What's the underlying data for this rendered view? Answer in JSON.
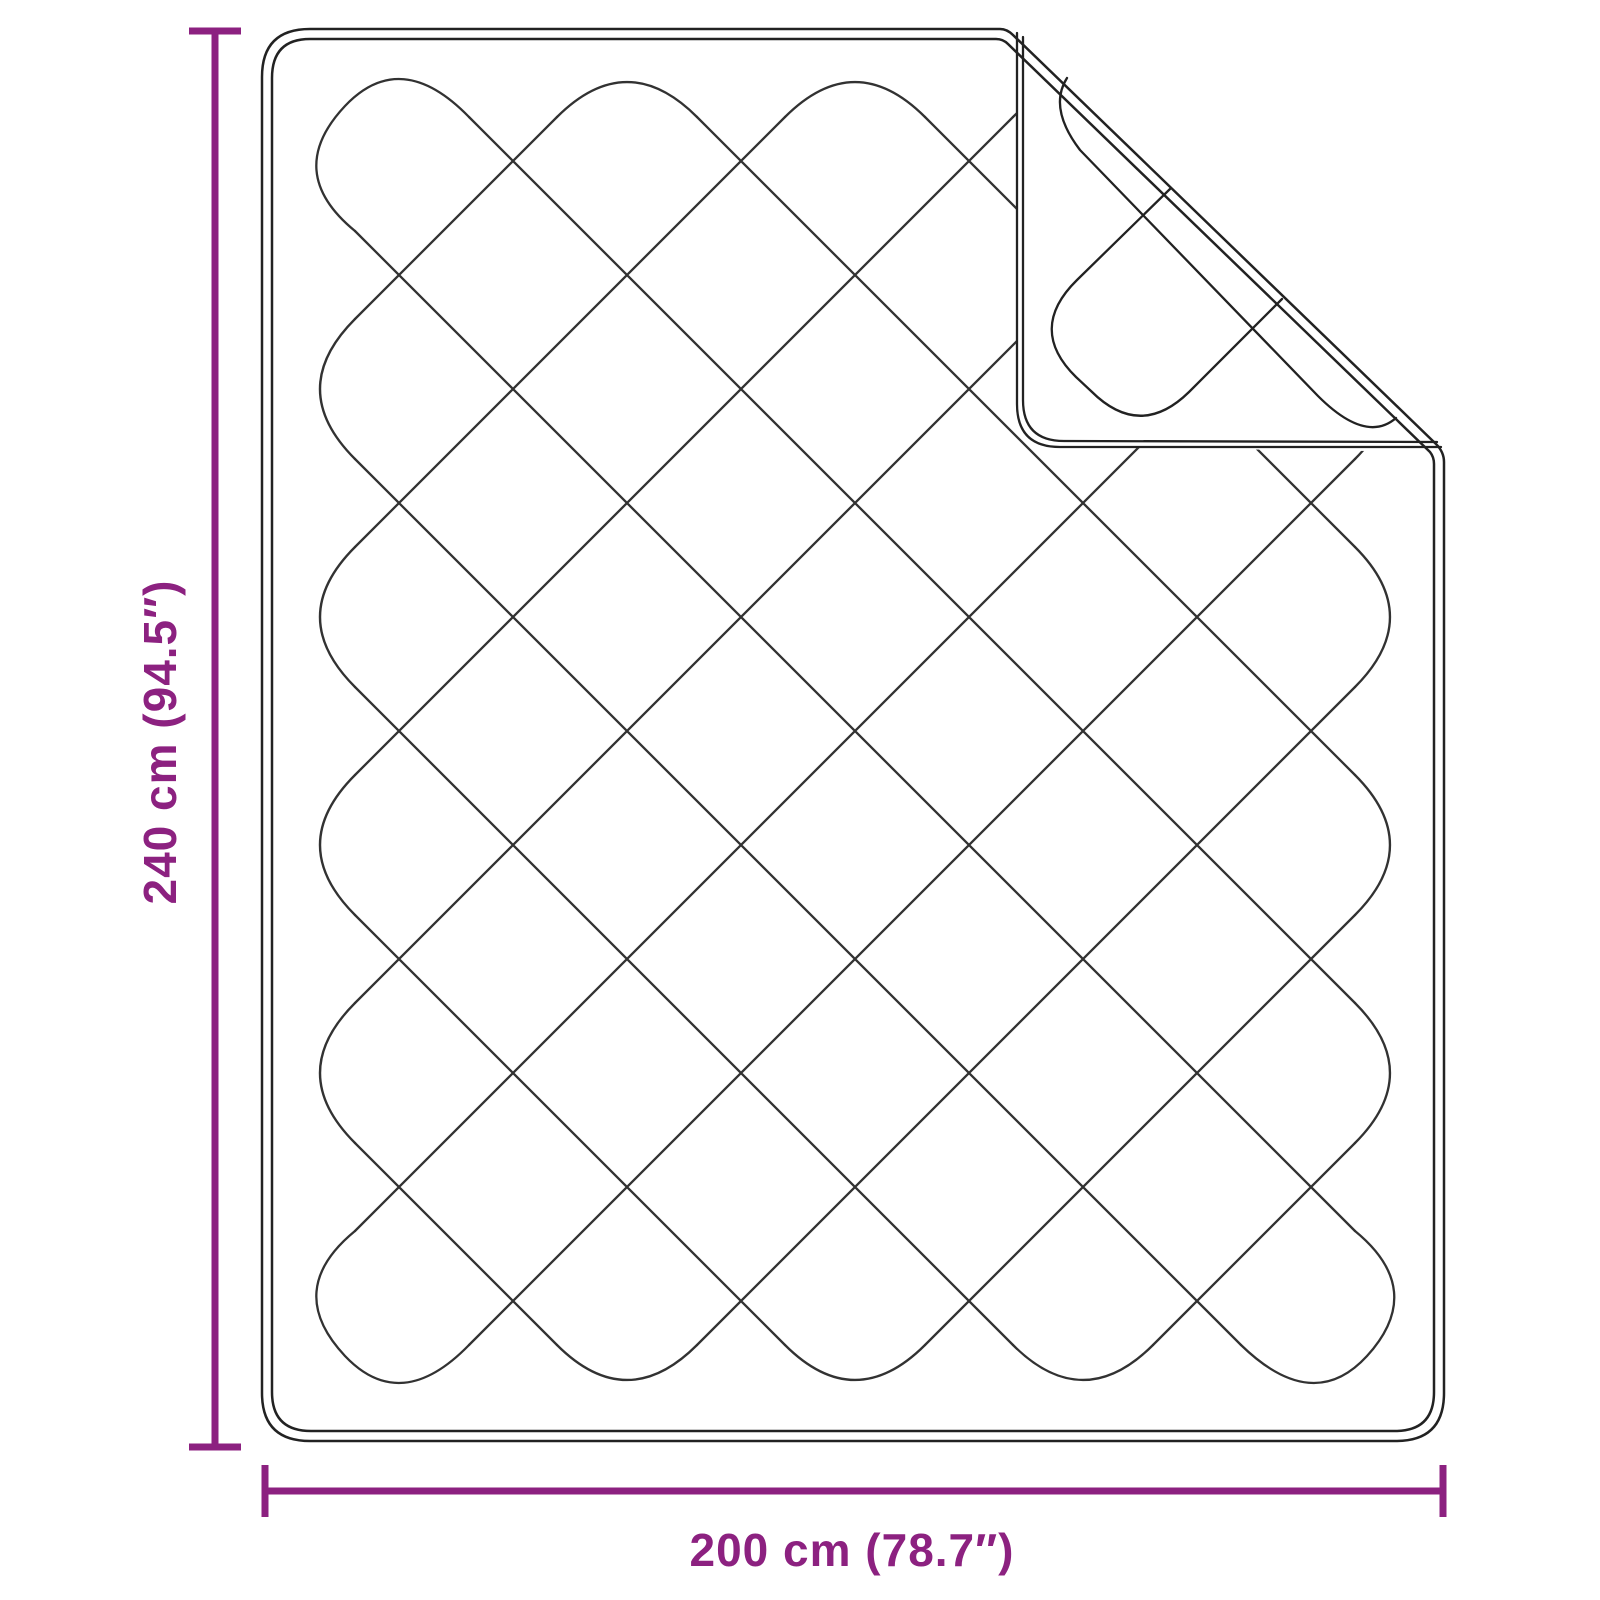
{
  "diagram": {
    "height_label": "240 cm (94.5″)",
    "width_label": "200 cm (78.7″)",
    "height_cm": 240,
    "width_cm": 200,
    "height_inches": 94.5,
    "width_inches": 78.7,
    "colors": {
      "accent": "#8C2180",
      "line": "#323232",
      "outline": "#222222",
      "background": "#FFFFFF"
    }
  }
}
